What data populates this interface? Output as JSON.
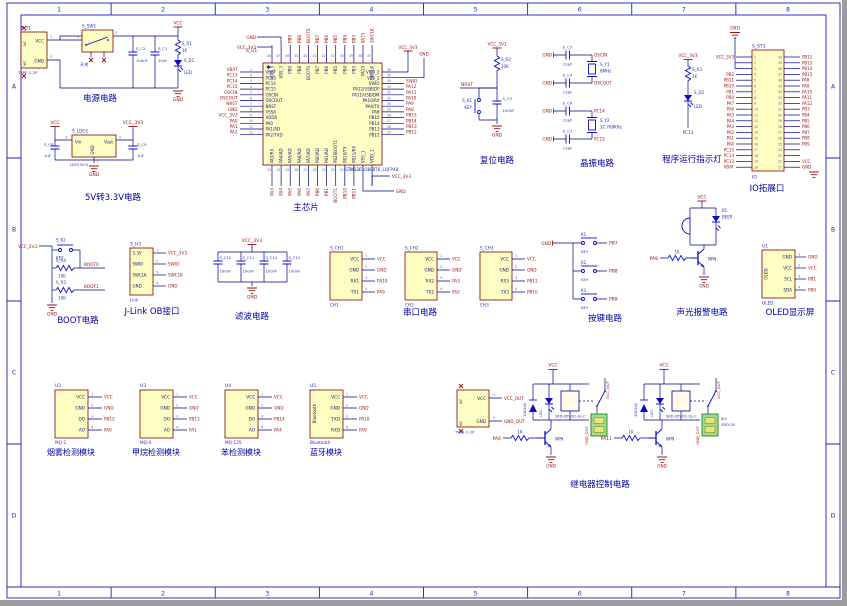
{
  "frame": {
    "cols": [
      "1",
      "2",
      "3",
      "4",
      "5",
      "6",
      "7",
      "8"
    ],
    "rows": [
      "A",
      "B",
      "C",
      "D"
    ]
  },
  "common": {
    "vcc": "VCC",
    "gnd": "GND",
    "vcc3": "VCC_3V3",
    "key": "KEY",
    "p1": "1",
    "p2": "2",
    "p3": "3",
    "p4": "4"
  },
  "power": {
    "caption": "电源电路",
    "t1": {
      "ref": "S_T1",
      "part": "TYPE-C-2P",
      "p_vcc": "VCC",
      "p_gnd": "GND",
      "nc": "NC",
      "n1": "1",
      "n2": "2"
    },
    "sw": {
      "ref": "S_SW1",
      "label": "开关",
      "n_left": "2",
      "n_right": "3"
    },
    "c1": {
      "ref": "S_C2",
      "val": "100uF"
    },
    "c2": {
      "ref": "S_C1",
      "val": "10uF"
    },
    "r": {
      "ref": "S_R1",
      "val": "1K"
    },
    "d": {
      "ref": "S_D1",
      "val": "LED"
    },
    "net_vcc": "VCC",
    "net_gnd": "GND"
  },
  "ldo": {
    "caption": "5V转3.3V电路",
    "ref": "S_LDO1",
    "part": "LDO(3V3)",
    "vin": "Vin",
    "vout": "Vout",
    "gnd": "GND",
    "n_in": "3",
    "n_out": "2",
    "n_gnd": "1",
    "cin": {
      "ref": "S_C8",
      "val": "1uF"
    },
    "cout": {
      "ref": "S_C9",
      "val": "1uF"
    },
    "net_in": "VCC",
    "net_out": "VCC_3V3",
    "net_gnd": "GND"
  },
  "mcu": {
    "caption": "主芯片",
    "ref": "S_U1",
    "part": "STM32F103C8T6_LQFP48",
    "left_pins": [
      {
        "num": "1",
        "name": "VBAT",
        "net": "VBAT"
      },
      {
        "num": "2",
        "name": "PC13",
        "net": "PC13"
      },
      {
        "num": "3",
        "name": "PC14",
        "net": "PC14"
      },
      {
        "num": "4",
        "name": "PC15",
        "net": "PC15"
      },
      {
        "num": "5",
        "name": "OSCIN",
        "net": "OSCIN"
      },
      {
        "num": "6",
        "name": "OSCOUT",
        "net": "OSCOUT"
      },
      {
        "num": "7",
        "name": "NRST",
        "net": "NRST"
      },
      {
        "num": "8",
        "name": "VSSA",
        "net": "GND"
      },
      {
        "num": "9",
        "name": "VDDA",
        "net": "VCC_3V3"
      },
      {
        "num": "10",
        "name": "PA0",
        "net": "PA0"
      },
      {
        "num": "11",
        "name": "PA1/AD",
        "net": "PA1"
      },
      {
        "num": "12",
        "name": "PA2/TXD",
        "net": "PA2"
      }
    ],
    "top_pins": [
      {
        "num": "48",
        "name": "VDD_3",
        "net": ""
      },
      {
        "num": "47",
        "name": "VSS_3",
        "net": ""
      },
      {
        "num": "46",
        "name": "PB9",
        "net": "PB9"
      },
      {
        "num": "45",
        "name": "PB8",
        "net": "PB8"
      },
      {
        "num": "44",
        "name": "BOOT0",
        "net": "BOOT0"
      },
      {
        "num": "43",
        "name": "PB7",
        "net": "PB7"
      },
      {
        "num": "42",
        "name": "PB6",
        "net": "PB6"
      },
      {
        "num": "41",
        "name": "PB5",
        "net": "PB5"
      },
      {
        "num": "40",
        "name": "PB4",
        "net": "PB4"
      },
      {
        "num": "39",
        "name": "PB3",
        "net": "PB3"
      },
      {
        "num": "38",
        "name": "PA15",
        "net": "PA15"
      },
      {
        "num": "37",
        "name": "SWCLK",
        "net": "SWCLK"
      }
    ],
    "right_pins": [
      {
        "num": "36",
        "name": "VDD_2",
        "net": ""
      },
      {
        "num": "35",
        "name": "VSS_2",
        "net": ""
      },
      {
        "num": "34",
        "name": "SWIO",
        "net": "SWIO"
      },
      {
        "num": "33",
        "name": "PA12/USB/DP",
        "net": "PA12"
      },
      {
        "num": "32",
        "name": "PA11/USB/DM",
        "net": "PA11"
      },
      {
        "num": "31",
        "name": "PA10/RX",
        "net": "PA10"
      },
      {
        "num": "30",
        "name": "PA9/TX",
        "net": "PA9"
      },
      {
        "num": "29",
        "name": "PA8",
        "net": "PA8"
      },
      {
        "num": "28",
        "name": "PB15",
        "net": "PB15"
      },
      {
        "num": "27",
        "name": "PB14",
        "net": "PB14"
      },
      {
        "num": "26",
        "name": "PB13",
        "net": "PB13"
      },
      {
        "num": "25",
        "name": "PB12",
        "net": "PB12"
      }
    ],
    "bottom_pins": [
      {
        "num": "13",
        "name": "PA3/RX",
        "net": "PA3"
      },
      {
        "num": "14",
        "name": "PA4/AD",
        "net": "PA4"
      },
      {
        "num": "15",
        "name": "PA5/AD",
        "net": "PA5"
      },
      {
        "num": "16",
        "name": "PA6/AD",
        "net": "PA6"
      },
      {
        "num": "17",
        "name": "PA7/AD",
        "net": "PA7"
      },
      {
        "num": "18",
        "name": "PB0/AD",
        "net": "PB0"
      },
      {
        "num": "19",
        "name": "PB1/AD",
        "net": "PB1"
      },
      {
        "num": "20",
        "name": "PB2/BOOT1",
        "net": "BOOT1"
      },
      {
        "num": "21",
        "name": "PB10/TX",
        "net": "PB10"
      },
      {
        "num": "22",
        "name": "PB11/RX",
        "net": "PB11"
      },
      {
        "num": "23",
        "name": "VSS_1",
        "net": ""
      },
      {
        "num": "24",
        "name": "VDD_1",
        "net": ""
      }
    ],
    "top_left_gnd": "GND",
    "top_left_vcc": "VCC_3V3",
    "top_right_vcc": "VCC_3V3",
    "top_right_gnd": "GND",
    "bottom_right_vcc": "VCC_3V3",
    "bottom_right_gnd": "GND"
  },
  "reset": {
    "caption": "复位电路",
    "net": "NRST",
    "r": {
      "ref": "S_R2",
      "val": "10K"
    },
    "k": {
      "ref": "S_K1",
      "val": "KEY"
    },
    "c": {
      "ref": "S_C5",
      "val": "100nF"
    },
    "net_vcc": "VCC_3V3",
    "net_gnd": "GND"
  },
  "xtal": {
    "caption": "晶振电路",
    "rows": [
      {
        "cref": "S_C3",
        "cval": "12pF",
        "net": "OSCIN"
      },
      {
        "cref": "S_C4",
        "cval": "12pF",
        "net": "OSCOUT"
      },
      {
        "cref": "S_C6",
        "cval": "12pF",
        "net": "PC14"
      },
      {
        "cref": "S_C7",
        "cval": "12pF",
        "net": "PC15"
      }
    ],
    "y1": {
      "ref": "S_Y1",
      "val": "8MHz"
    },
    "y2": {
      "ref": "S_Y2",
      "val": "32.768KHz"
    }
  },
  "pled": {
    "caption": "程序运行指示灯",
    "r": {
      "ref": "S_R3",
      "val": "1K"
    },
    "d": {
      "ref": "S_D2",
      "val": "LED"
    },
    "net": "PC13",
    "net_vcc": "VCC_3V3"
  },
  "ioport": {
    "caption": "IO拓展口",
    "ref": "S_ST1",
    "part": "IO",
    "net_gnd": "GND",
    "left": [
      {
        "num": "1",
        "net": "VCC_3V3"
      },
      {
        "num": "2",
        "net": ""
      },
      {
        "num": "3",
        "net": ""
      },
      {
        "num": "4",
        "net": "PB2"
      },
      {
        "num": "5",
        "net": "PB11"
      },
      {
        "num": "6",
        "net": "PB10"
      },
      {
        "num": "7",
        "net": "PB1"
      },
      {
        "num": "8",
        "net": "PB0"
      },
      {
        "num": "9",
        "net": "PA7"
      },
      {
        "num": "10",
        "net": "PA6"
      },
      {
        "num": "11",
        "net": "PA5"
      },
      {
        "num": "12",
        "net": "PA4"
      },
      {
        "num": "13",
        "net": "PA3"
      },
      {
        "num": "14",
        "net": "PA2"
      },
      {
        "num": "15",
        "net": "PA1"
      },
      {
        "num": "16",
        "net": "PA0"
      },
      {
        "num": "17",
        "net": "PC15"
      },
      {
        "num": "18",
        "net": "PC14"
      },
      {
        "num": "19",
        "net": "PC13"
      },
      {
        "num": "20",
        "net": "VBAT"
      }
    ],
    "right": [
      {
        "num": "40",
        "net": "PB12"
      },
      {
        "num": "39",
        "net": "PB13"
      },
      {
        "num": "38",
        "net": "PB14"
      },
      {
        "num": "37",
        "net": "PB15"
      },
      {
        "num": "36",
        "net": "PA8"
      },
      {
        "num": "35",
        "net": "PA9"
      },
      {
        "num": "34",
        "net": "PA10"
      },
      {
        "num": "33",
        "net": "PA11"
      },
      {
        "num": "32",
        "net": "PA12"
      },
      {
        "num": "31",
        "net": "PB3"
      },
      {
        "num": "30",
        "net": "PB4"
      },
      {
        "num": "29",
        "net": "PB5"
      },
      {
        "num": "28",
        "net": "PB6"
      },
      {
        "num": "27",
        "net": "PB7"
      },
      {
        "num": "26",
        "net": "PB8"
      },
      {
        "num": "25",
        "net": "PB9"
      },
      {
        "num": "24",
        "net": ""
      },
      {
        "num": "23",
        "net": ""
      },
      {
        "num": "22",
        "net": "VCC"
      },
      {
        "num": "21",
        "net": "GND"
      }
    ]
  },
  "boot": {
    "caption": "BOOT电路",
    "net_vcc": "VCC_3V3",
    "net_gnd": "GND",
    "k": {
      "ref": "S_K2",
      "val": "KEY"
    },
    "r1": {
      "ref": "S_R4",
      "val": "10K",
      "net": "BOOT0"
    },
    "r2": {
      "ref": "S_R5",
      "val": "10K",
      "net": "BOOT1"
    }
  },
  "jlink": {
    "caption": "J-Link OB接口",
    "ref": "S_H1",
    "part": "Link",
    "pins": [
      {
        "name": "3.3V",
        "num": "1",
        "net": "VCC_3V3"
      },
      {
        "name": "SWIO",
        "num": "2",
        "net": "SWIO"
      },
      {
        "name": "SWCLK",
        "num": "3",
        "net": "SWCLK"
      },
      {
        "name": "GND",
        "num": "4",
        "net": "GND"
      }
    ]
  },
  "filter": {
    "caption": "滤波电路",
    "net_vcc": "VCC_3V3",
    "net_gnd": "GND",
    "caps": [
      {
        "ref": "S_C10",
        "val": "100nF"
      },
      {
        "ref": "S_C11",
        "val": "100nF"
      },
      {
        "ref": "S_C12",
        "val": "100nF"
      },
      {
        "ref": "S_C13",
        "val": "100nF"
      }
    ]
  },
  "serial": {
    "caption": "串口电路",
    "ports": [
      {
        "ref": "S_CH1",
        "part": "CH1",
        "rx": "RX1",
        "tx": "TX1",
        "rxnet": "PA10",
        "txnet": "PA9"
      },
      {
        "ref": "S_CH2",
        "part": "CH2",
        "rx": "RX2",
        "tx": "TX2",
        "rxnet": "PA3",
        "txnet": "PA2"
      },
      {
        "ref": "S_CH3",
        "part": "CH3",
        "rx": "RX3",
        "tx": "TX3",
        "rxnet": "PB11",
        "txnet": "PB10"
      }
    ]
  },
  "keys": {
    "caption": "按键电路",
    "net_gnd": "GND",
    "items": [
      {
        "ref": "K1",
        "net": "PB7"
      },
      {
        "ref": "K2",
        "net": "PB8"
      },
      {
        "ref": "K3",
        "net": "PB9"
      }
    ]
  },
  "alarm": {
    "caption": "声光报警电路",
    "buz_ref": "B1",
    "buz_val": "BEEP",
    "npn": "NPN",
    "r_val": "1K",
    "in_net": "PA8",
    "net_vcc": "VCC",
    "net_gnd": "GND"
  },
  "oled": {
    "caption": "OLED显示屏",
    "ref": "U1",
    "part": "OLED",
    "vtext": "OLED",
    "pins": [
      {
        "name": "GND",
        "num": "1",
        "net": "GND"
      },
      {
        "name": "VCC",
        "num": "2",
        "net": "VCC"
      },
      {
        "name": "SCL",
        "num": "3",
        "net": "PB1"
      },
      {
        "name": "SDA",
        "num": "4",
        "net": "PB0"
      }
    ]
  },
  "modules": {
    "items": [
      {
        "ref": "U2",
        "part": "MQ-2",
        "caption": "烟雾检测模块",
        "vtext": "",
        "p3": "DO",
        "p4": "AO",
        "n3": "PB12",
        "n4": "PA0"
      },
      {
        "ref": "U3",
        "part": "MQ-4",
        "caption": "甲烷检测模块",
        "vtext": "",
        "p3": "DO",
        "p4": "AO",
        "n3": "PB13",
        "n4": "PA1"
      },
      {
        "ref": "U4",
        "part": "MQ-135",
        "caption": "苯检测模块",
        "vtext": "",
        "p3": "DO",
        "p4": "AO",
        "n3": "PB14",
        "n4": "PA4"
      },
      {
        "ref": "U5",
        "part": "Bluetooth",
        "caption": "蓝牙模块",
        "vtext": "Bluetooth",
        "p3": "TXD",
        "p4": "RXD",
        "n3": "PA10",
        "n4": "PA9"
      }
    ]
  },
  "relay": {
    "caption": "继电器控制电路",
    "part": "SRD-05VDC-SL-C",
    "r_val": "1K",
    "npn": "NPN",
    "d1_val": "1N4148",
    "d2_val": "LED",
    "net_vcc": "VCC",
    "net_gnd": "GND",
    "t": {
      "part": "TYPE-C-2P",
      "p_vcc": "VCC",
      "p_gnd": "GND",
      "nc": "NC",
      "n1": "1",
      "n2": "2",
      "net_vcc": "VCC_OUT",
      "net_gnd": "GND_OUT"
    },
    "vcc_out": "VCC_OUT",
    "gnd_out": "GND_OUT",
    "channels": [
      {
        "in_net": "PA6",
        "jk_ref": "",
        "jk_part": ""
      },
      {
        "in_net": "PA11",
        "jk_ref": "JK1",
        "jk_part": "SRD-05"
      }
    ]
  }
}
